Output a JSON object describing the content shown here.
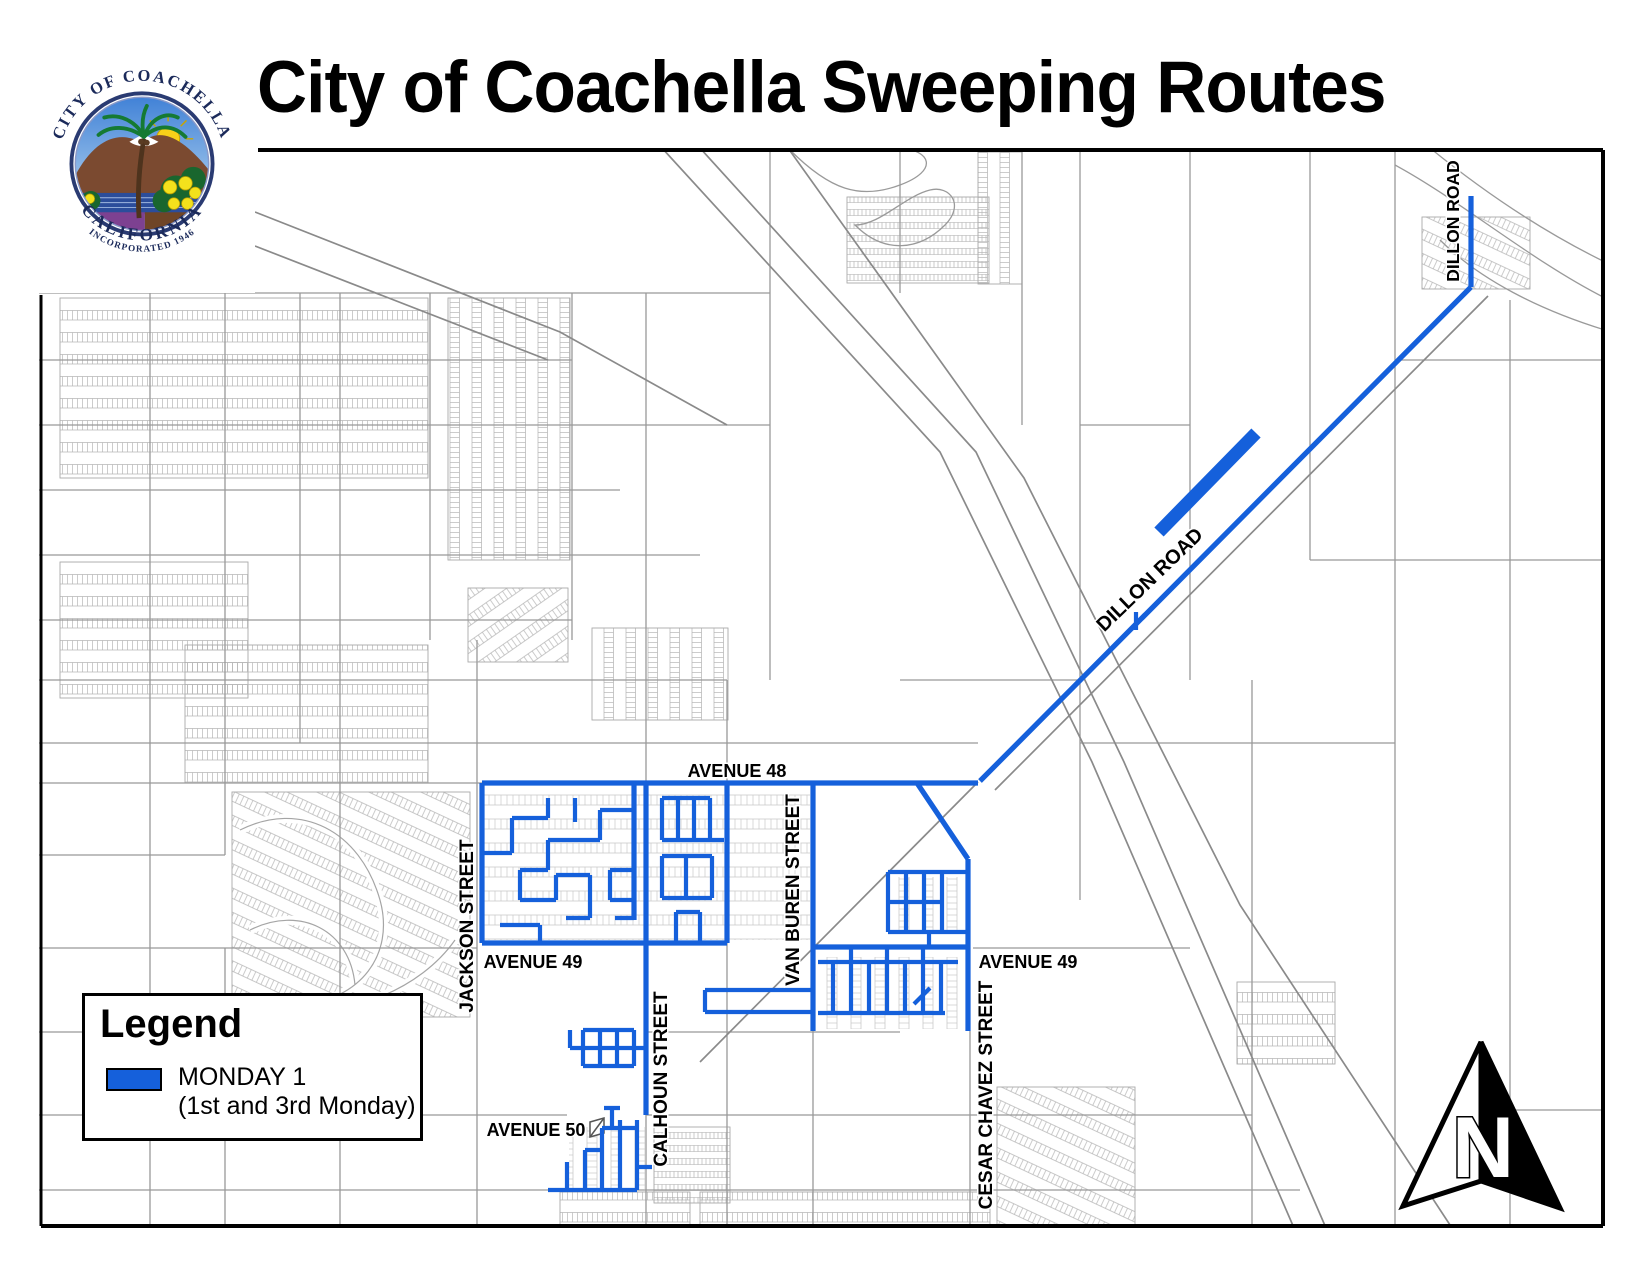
{
  "title": "City of Coachella Sweeping Routes",
  "logo": {
    "arc_top": "CITY OF COACHELLA",
    "arc_bottom": "CALIFORNIA",
    "arc_sub": "INCORPORATED 1946"
  },
  "legend": {
    "title": "Legend",
    "items": [
      {
        "label": "MONDAY 1",
        "sublabel": "(1st and 3rd Monday)",
        "color": "#1560DB"
      }
    ]
  },
  "map": {
    "route_color": "#1560DB",
    "street_line_color": "#999999",
    "parcel_line_color": "#b6b6b6",
    "labels": {
      "dillon_top": "DILLON ROAD",
      "dillon_diagonal": "DILLON ROAD",
      "avenue_48": "AVENUE 48",
      "avenue_49_west": "AVENUE 49",
      "avenue_49_east": "AVENUE 49",
      "avenue_50": "AVENUE 50",
      "jackson": "JACKSON STREET",
      "van_buren": "VAN BUREN STREET",
      "calhoun": "CALHOUN STREET",
      "cesar_chavez": "CESAR CHAVEZ STREET"
    },
    "north_arrow_letter": "N"
  }
}
